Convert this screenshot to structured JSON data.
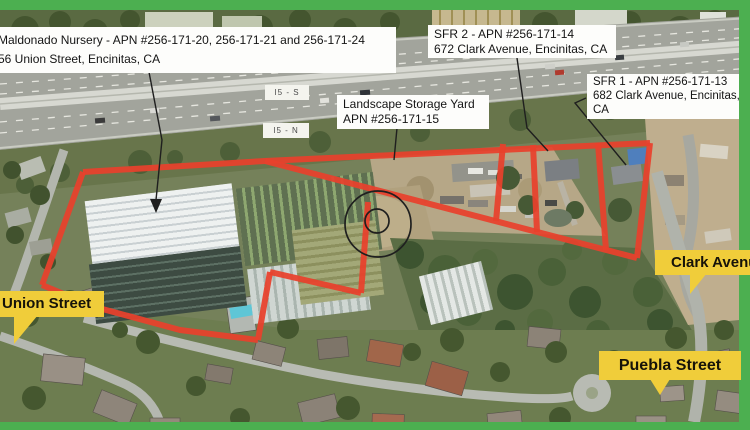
{
  "annotations": {
    "parcel_labels": [
      {
        "id": "maldonado",
        "line1": "Maldonado Nursery - APN #256-171-20, 256-171-21 and 256-171-24",
        "line2": "56 Union Street, Encinitas, CA"
      },
      {
        "id": "sfr2",
        "line1": "SFR 2 - APN #256-171-14",
        "line2": "672 Clark Avenue, Encinitas, CA"
      },
      {
        "id": "sfr1",
        "line1": "SFR 1 - APN #256-171-13",
        "line2": "682 Clark Avenue, Encinitas,",
        "line3": "CA"
      },
      {
        "id": "storage",
        "line1": "Landscape Storage Yard",
        "line2": "APN #256-171-15"
      }
    ],
    "street_labels": [
      {
        "id": "union",
        "text": "Union Street"
      },
      {
        "id": "clark",
        "text": "Clark Avenue"
      },
      {
        "id": "puebla",
        "text": "Puebla Street"
      }
    ],
    "highway_signs": [
      {
        "text": "I5 - S"
      },
      {
        "text": "I5 - N"
      }
    ],
    "colors": {
      "parcel_outline": "#e8412c",
      "street_label_bg": "#f0cd3a",
      "frame_green": "#4caf50",
      "leader": "#1f1f1f"
    }
  },
  "overlay": {
    "red_lines": [
      [
        [
          83,
          172
        ],
        [
          265,
          161
        ],
        [
          650,
          143
        ]
      ],
      [
        [
          83,
          172
        ],
        [
          42,
          285
        ]
      ],
      [
        [
          42,
          285
        ],
        [
          95,
          307
        ],
        [
          180,
          330
        ],
        [
          258,
          340
        ]
      ],
      [
        [
          258,
          340
        ],
        [
          270,
          272
        ]
      ],
      [
        [
          270,
          272
        ],
        [
          361,
          293
        ]
      ],
      [
        [
          361,
          293
        ],
        [
          368,
          202
        ]
      ],
      [
        [
          265,
          161
        ],
        [
          637,
          258
        ]
      ],
      [
        [
          650,
          143
        ],
        [
          637,
          258
        ]
      ],
      [
        [
          503,
          144
        ],
        [
          496,
          221
        ]
      ],
      [
        [
          533,
          145
        ],
        [
          537,
          232
        ]
      ],
      [
        [
          598,
          143
        ],
        [
          606,
          250
        ]
      ]
    ],
    "circle": {
      "cx": 378,
      "cy": 224,
      "r_outer": 33,
      "r_inner": 12,
      "inner_cx": 377,
      "inner_cy": 221
    },
    "leaders": [
      {
        "points": [
          [
            149,
            72
          ],
          [
            162,
            140
          ],
          [
            156,
            200
          ]
        ]
      },
      {
        "points": [
          [
            397,
            128
          ],
          [
            394,
            160
          ]
        ]
      },
      {
        "points": [
          [
            517,
            58
          ],
          [
            527,
            128
          ],
          [
            548,
            151
          ]
        ]
      },
      {
        "points": [
          [
            586,
            98
          ],
          [
            575,
            103
          ],
          [
            626,
            165
          ]
        ]
      }
    ],
    "arrowheads": [
      [
        [
          150,
          199
        ],
        [
          162,
          199
        ],
        [
          156,
          213
        ]
      ]
    ]
  }
}
